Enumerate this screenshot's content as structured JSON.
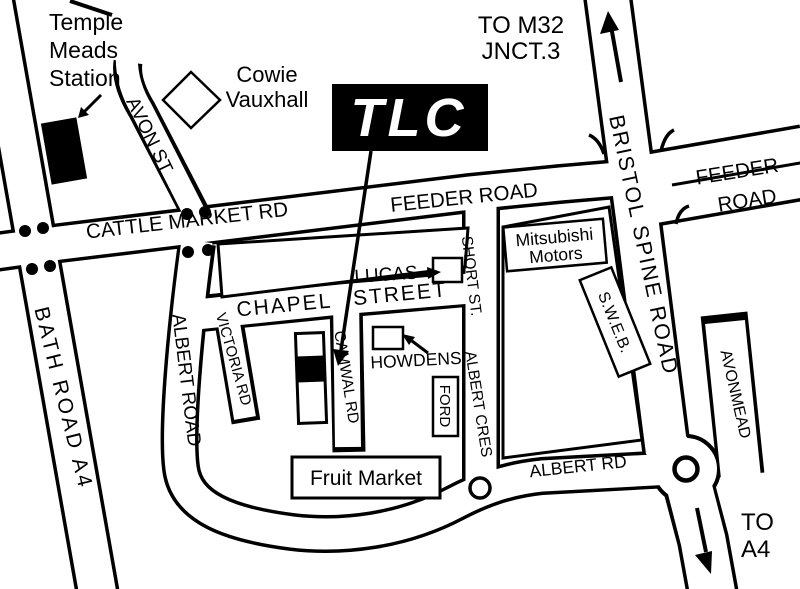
{
  "title": "TLC location map",
  "colors": {
    "ink": "#000000",
    "paper": "#ffffff"
  },
  "landmarks": {
    "station": {
      "lines": [
        "Temple",
        "Meads",
        "Station"
      ]
    },
    "cowie_vauxhall": {
      "lines": [
        "Cowie",
        "Vauxhall"
      ]
    },
    "tlc_logo": "TLC",
    "lucas": "LUCAS",
    "howdens": "HOWDENS",
    "ford": "FORD",
    "fruit_market": "Fruit Market",
    "mitsubishi": {
      "lines": [
        "Mitsubishi",
        "Motors"
      ]
    },
    "sweb": "S.W.E.B."
  },
  "destinations": {
    "m32": {
      "lines": [
        "TO M32",
        "JNCT.3"
      ]
    },
    "a4": {
      "lines": [
        "TO",
        "A4"
      ]
    }
  },
  "roads": {
    "cattle_market": "CATTLE MARKET RD",
    "feeder_west": "FEEDER ROAD",
    "feeder_east_line1": "FEEDER",
    "feeder_east_line2": "ROAD",
    "bristol_spine": "BRISTOL SPINE ROAD",
    "avon": "AVON ST",
    "bath": "BATH ROAD A4",
    "albert_road": "ALBERT ROAD",
    "albert_rd": "ALBERT RD",
    "chapel": "CHAPEL STREET",
    "victoria": "VICTORIA RD",
    "camwal": "CAMWAL RD",
    "short": "SHORT ST.",
    "albert_cres": "ALBERT CRES",
    "avonmead": "AVONMEAD"
  }
}
